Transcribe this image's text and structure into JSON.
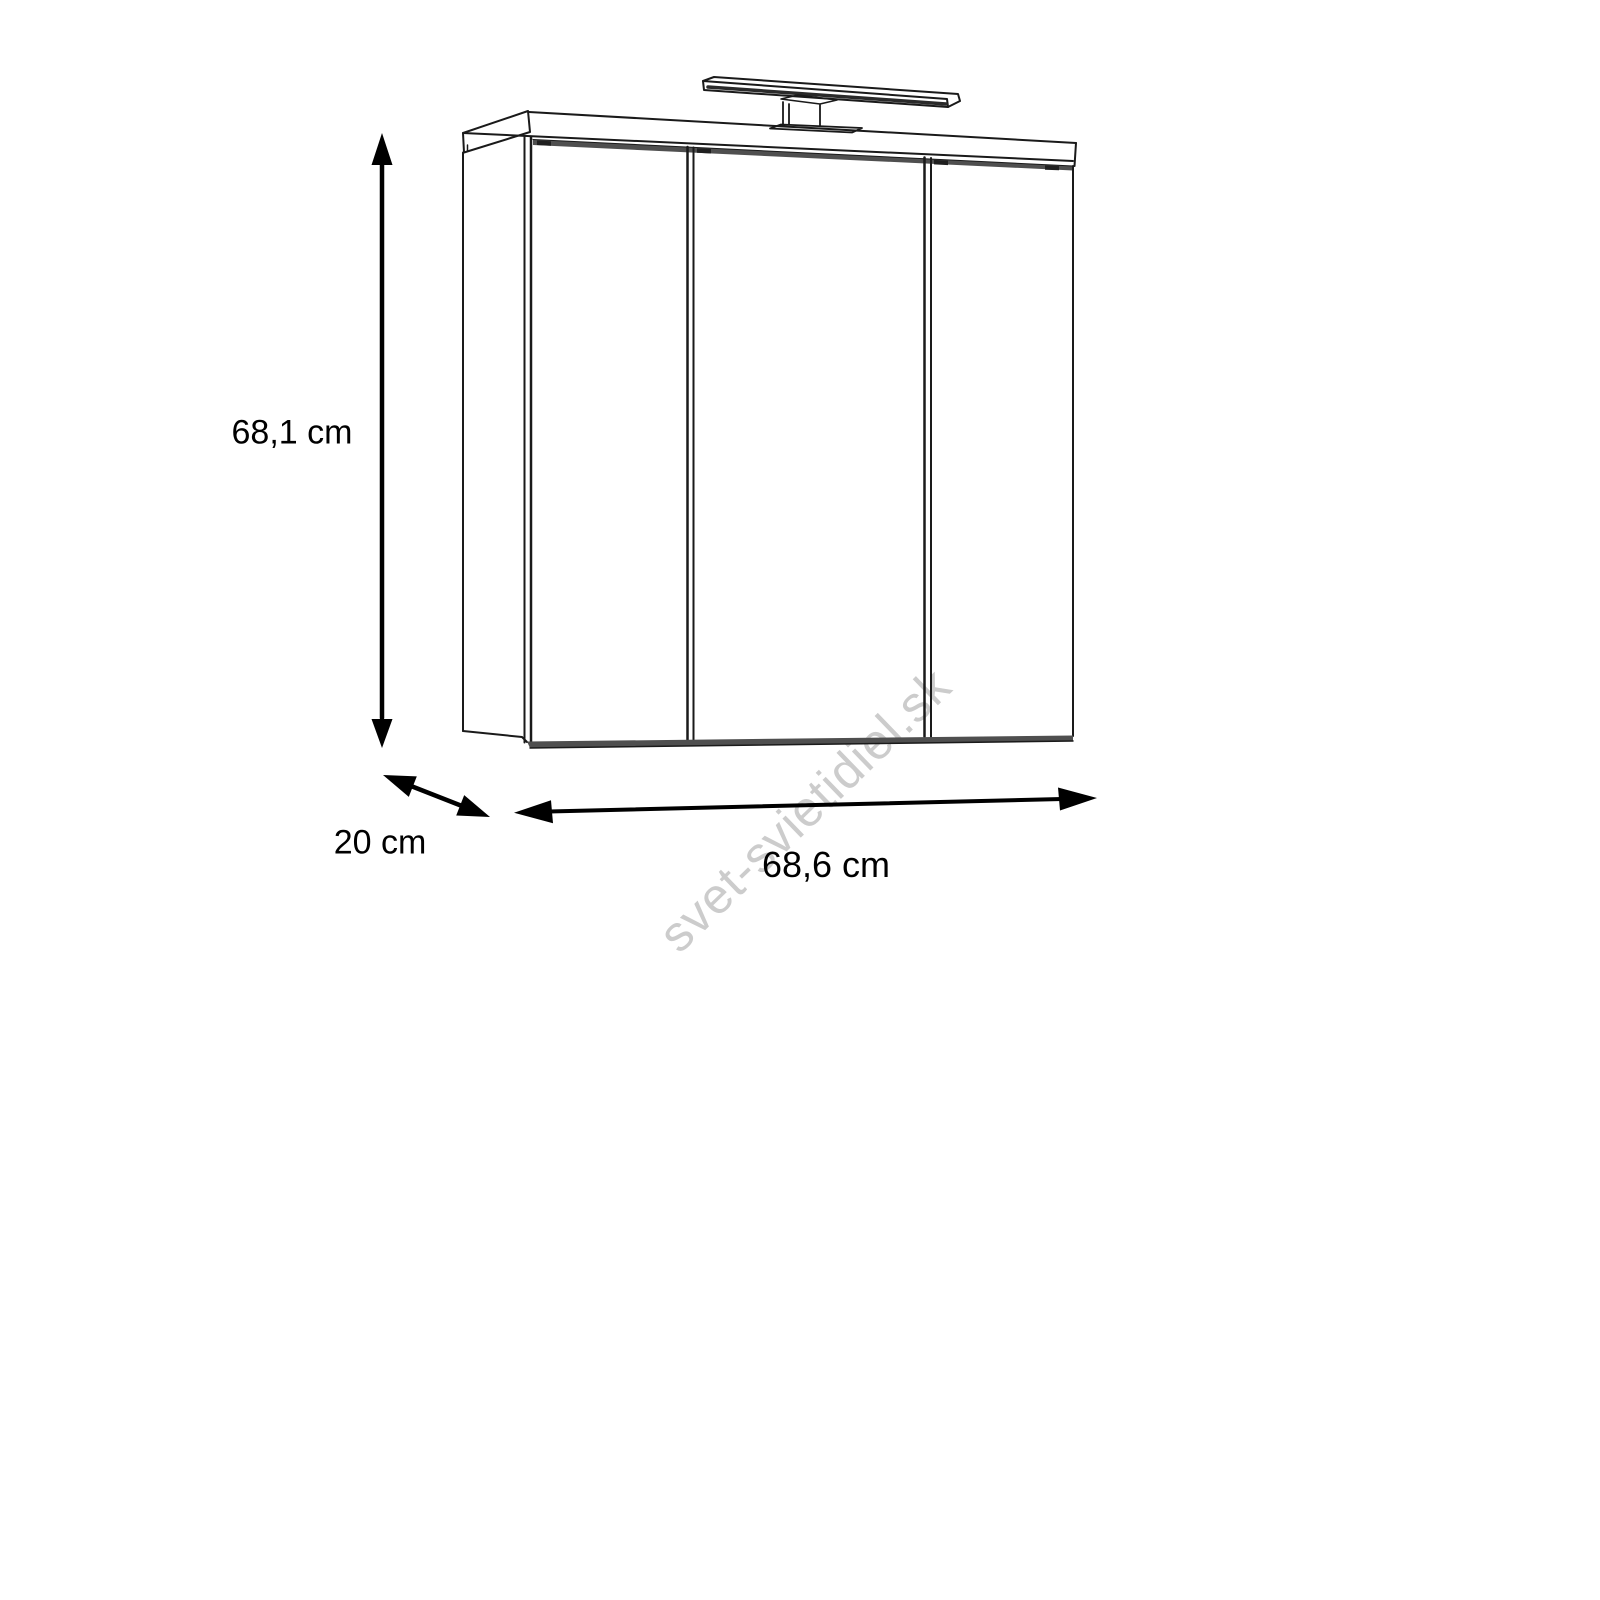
{
  "drawing": {
    "type": "product-dimension-diagram",
    "subject": "three-door mirrored bathroom wall cabinet with overhead lamp",
    "dimensions": {
      "height": {
        "label": "68,1 cm",
        "value": 68.1,
        "unit": "cm"
      },
      "depth": {
        "label": "20 cm",
        "value": 20,
        "unit": "cm"
      },
      "width": {
        "label": "68,6 cm",
        "value": 68.6,
        "unit": "cm"
      }
    },
    "watermark": {
      "text": "svet-svietidiel.sk",
      "color": "#cccccc"
    },
    "colors": {
      "background": "#ffffff",
      "line": "#1a1a1a",
      "arrow": "#000000",
      "shadow_band": "#4f4f4f"
    }
  }
}
